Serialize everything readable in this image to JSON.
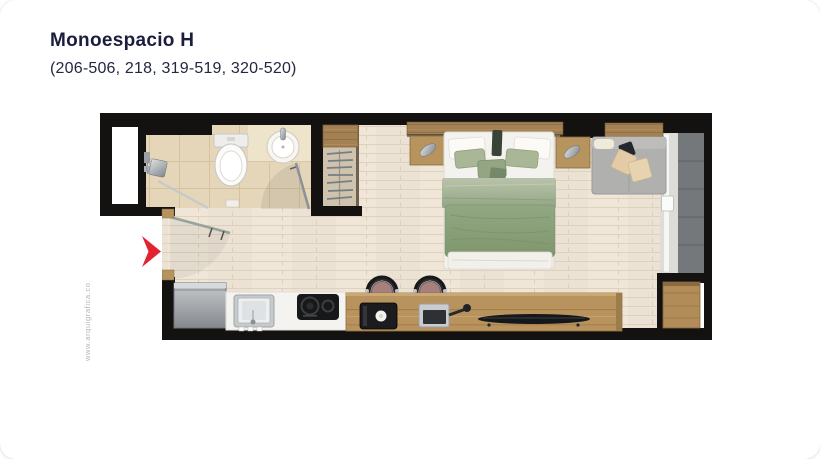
{
  "header": {
    "title": "Monoespacio H",
    "subtitle": "(206-506, 218, 319-519, 320-520)"
  },
  "watermark": "www.arquigrafica.co",
  "floorplan": {
    "type": "apartment-floor-plan",
    "unit_name": "Monoespacio H",
    "unit_numbers": "206-506, 218, 319-519, 320-520",
    "entrance_marker": "red-chevron-arrow pointing right at entry door (left wall)",
    "rooms": [
      "bathroom",
      "closet",
      "main-room-bedroom",
      "kitchen-bar",
      "balcony"
    ],
    "furniture_icons": [
      "shower-head-icon",
      "shower-glass-icon",
      "toilet-icon",
      "washbasin-icon",
      "wardrobe-shelf-icon",
      "hanger-rail-icon",
      "entry-door-swing-icon",
      "bathroom-door-swing-icon",
      "headboard-shelf-icon",
      "nightstand-icon",
      "wall-lamp-icon",
      "double-bed-icon",
      "sofa-with-cushions-icon",
      "sliding-glass-door-icon",
      "fridge-icon",
      "kitchen-sink-icon",
      "cooktop-icon",
      "coffee-machine-icon",
      "pan-icon",
      "tv-console-icon",
      "bar-stool-icon",
      "side-cabinet-icon"
    ]
  },
  "colors": {
    "text": "#1a1e3c",
    "wall": "#141210",
    "floor": "#ece2d4",
    "bathtile": "#e5d6ba",
    "wood": "#b8935e",
    "wood_dark": "#a38154",
    "bed_green": "#8ba17e",
    "bed_green_light": "#a9b797",
    "sofa_gray": "#b0b0ae",
    "balcony_tile": "#75787b",
    "arrow_red": "#e32330",
    "watermark": "#b5b5b5",
    "card_bg": "#ffffff"
  }
}
